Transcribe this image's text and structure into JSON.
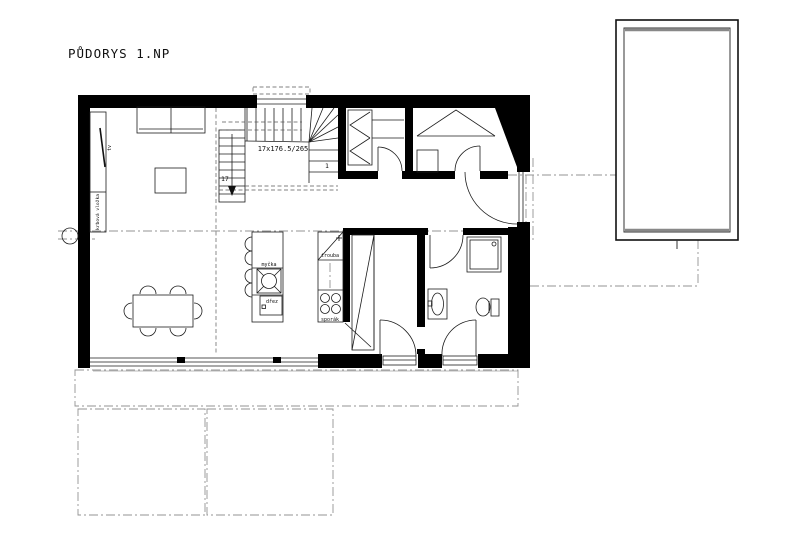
{
  "title": "PŮDORYS 1.NP",
  "stairs": {
    "dimension_label": "17x176.5/265",
    "last_step": "17",
    "first_step": "1"
  },
  "labels": {
    "tv": "tv",
    "fireplace": "krbová vložka",
    "dishwasher": "myčka",
    "sink": "dřez",
    "oven": "trouba",
    "stove": "sporák"
  },
  "colors": {
    "wall": "#000000",
    "line": "#1c1c1c",
    "guide": "#939393",
    "background": "#ffffff"
  }
}
